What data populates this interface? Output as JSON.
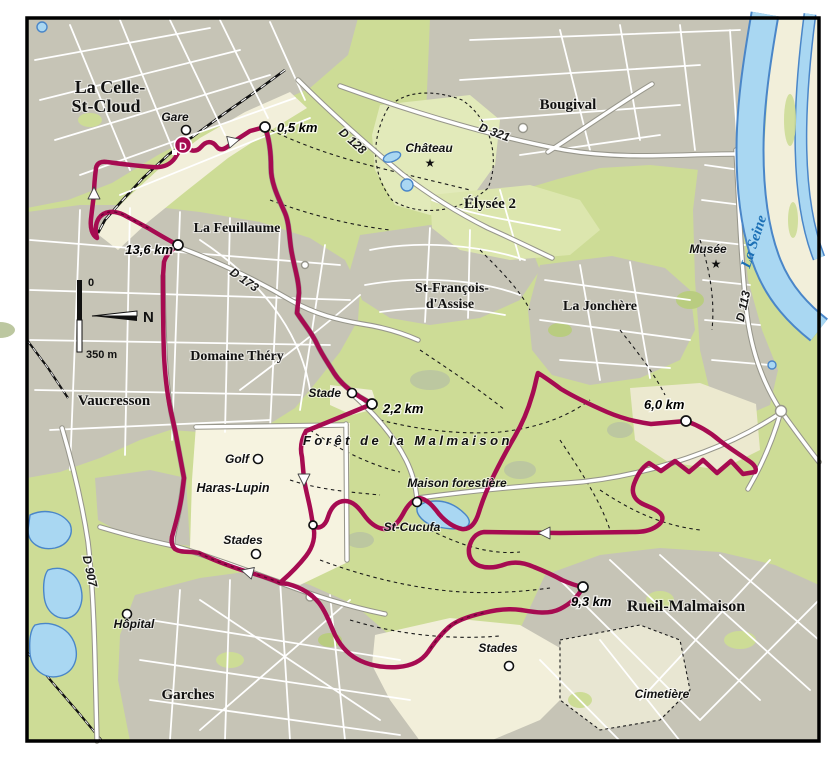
{
  "towns": {
    "la_celle_line1": "La Celle-",
    "la_celle_line2": "St-Cloud",
    "bougival": "Bougival",
    "elysee": "Élysée 2",
    "feuillaume": "La Feuillaume",
    "st_francois_line1": "St-François-",
    "st_francois_line2": "d'Assise",
    "jonchere": "La Jonchère",
    "domaine_thery": "Domaine Théry",
    "vaucresson": "Vaucresson",
    "rueil": "Rueil-Malmaison",
    "garches": "Garches"
  },
  "pois": {
    "gare": "Gare",
    "chateau": "Château",
    "musee": "Musée",
    "stade": "Stade",
    "golf": "Golf",
    "haras": "Haras-Lupin",
    "stades_haras": "Stades",
    "stades_bottom": "Stades",
    "maison_forestiere": "Maison forestière",
    "st_cucufa": "St-Cucufa",
    "hopital": "Hôpital",
    "cimetiere": "Cimetière",
    "foret": "Forêt de la Malmaison"
  },
  "roads": {
    "d321": "D 321",
    "d128": "D 128",
    "d173": "D 173",
    "d907": "D 907",
    "d113": "D 113"
  },
  "river": {
    "label": "La Seine"
  },
  "route": {
    "start": "D",
    "markers": [
      {
        "label": "0,5 km"
      },
      {
        "label": "2,2 km"
      },
      {
        "label": "6,0 km"
      },
      {
        "label": "9,3 km"
      },
      {
        "label": "13,6 km"
      }
    ],
    "color": "#a60b51"
  },
  "scalebar": {
    "zero": "0",
    "length": "350 m",
    "north": "N"
  },
  "icons": {
    "star": "★"
  },
  "colors": {
    "forest": "#cddc96",
    "urban": "#c6c4b6",
    "open": "#f2efda",
    "water": "#a9d7f2",
    "water_edge": "#4a86c8",
    "route": "#a60b51",
    "river_label": "#1b6fb5"
  }
}
